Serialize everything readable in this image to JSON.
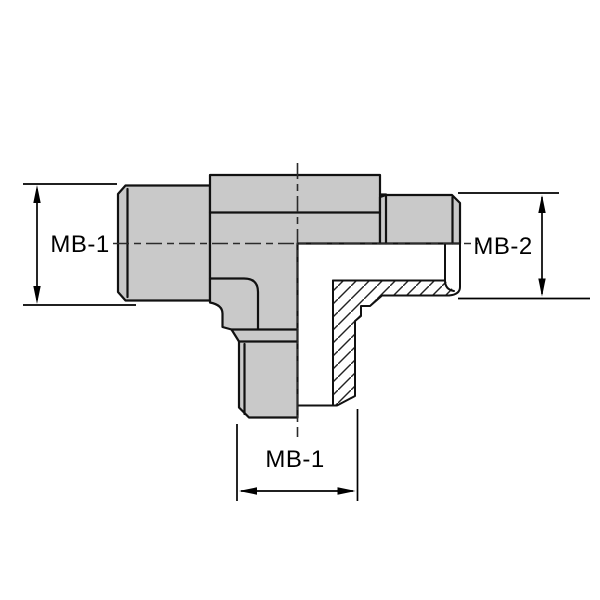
{
  "drawing": {
    "kind": "tee-fitting-section-view",
    "colors": {
      "body_fill": "#c9c9c9",
      "outline": "#111111",
      "background": "#ffffff",
      "hatch": "#222222"
    }
  },
  "dimensions": {
    "left": {
      "label": "MB-1",
      "orientation": "vertical"
    },
    "right": {
      "label": "MB-2",
      "orientation": "vertical"
    },
    "bottom": {
      "label": "MB-1",
      "orientation": "horizontal"
    }
  }
}
